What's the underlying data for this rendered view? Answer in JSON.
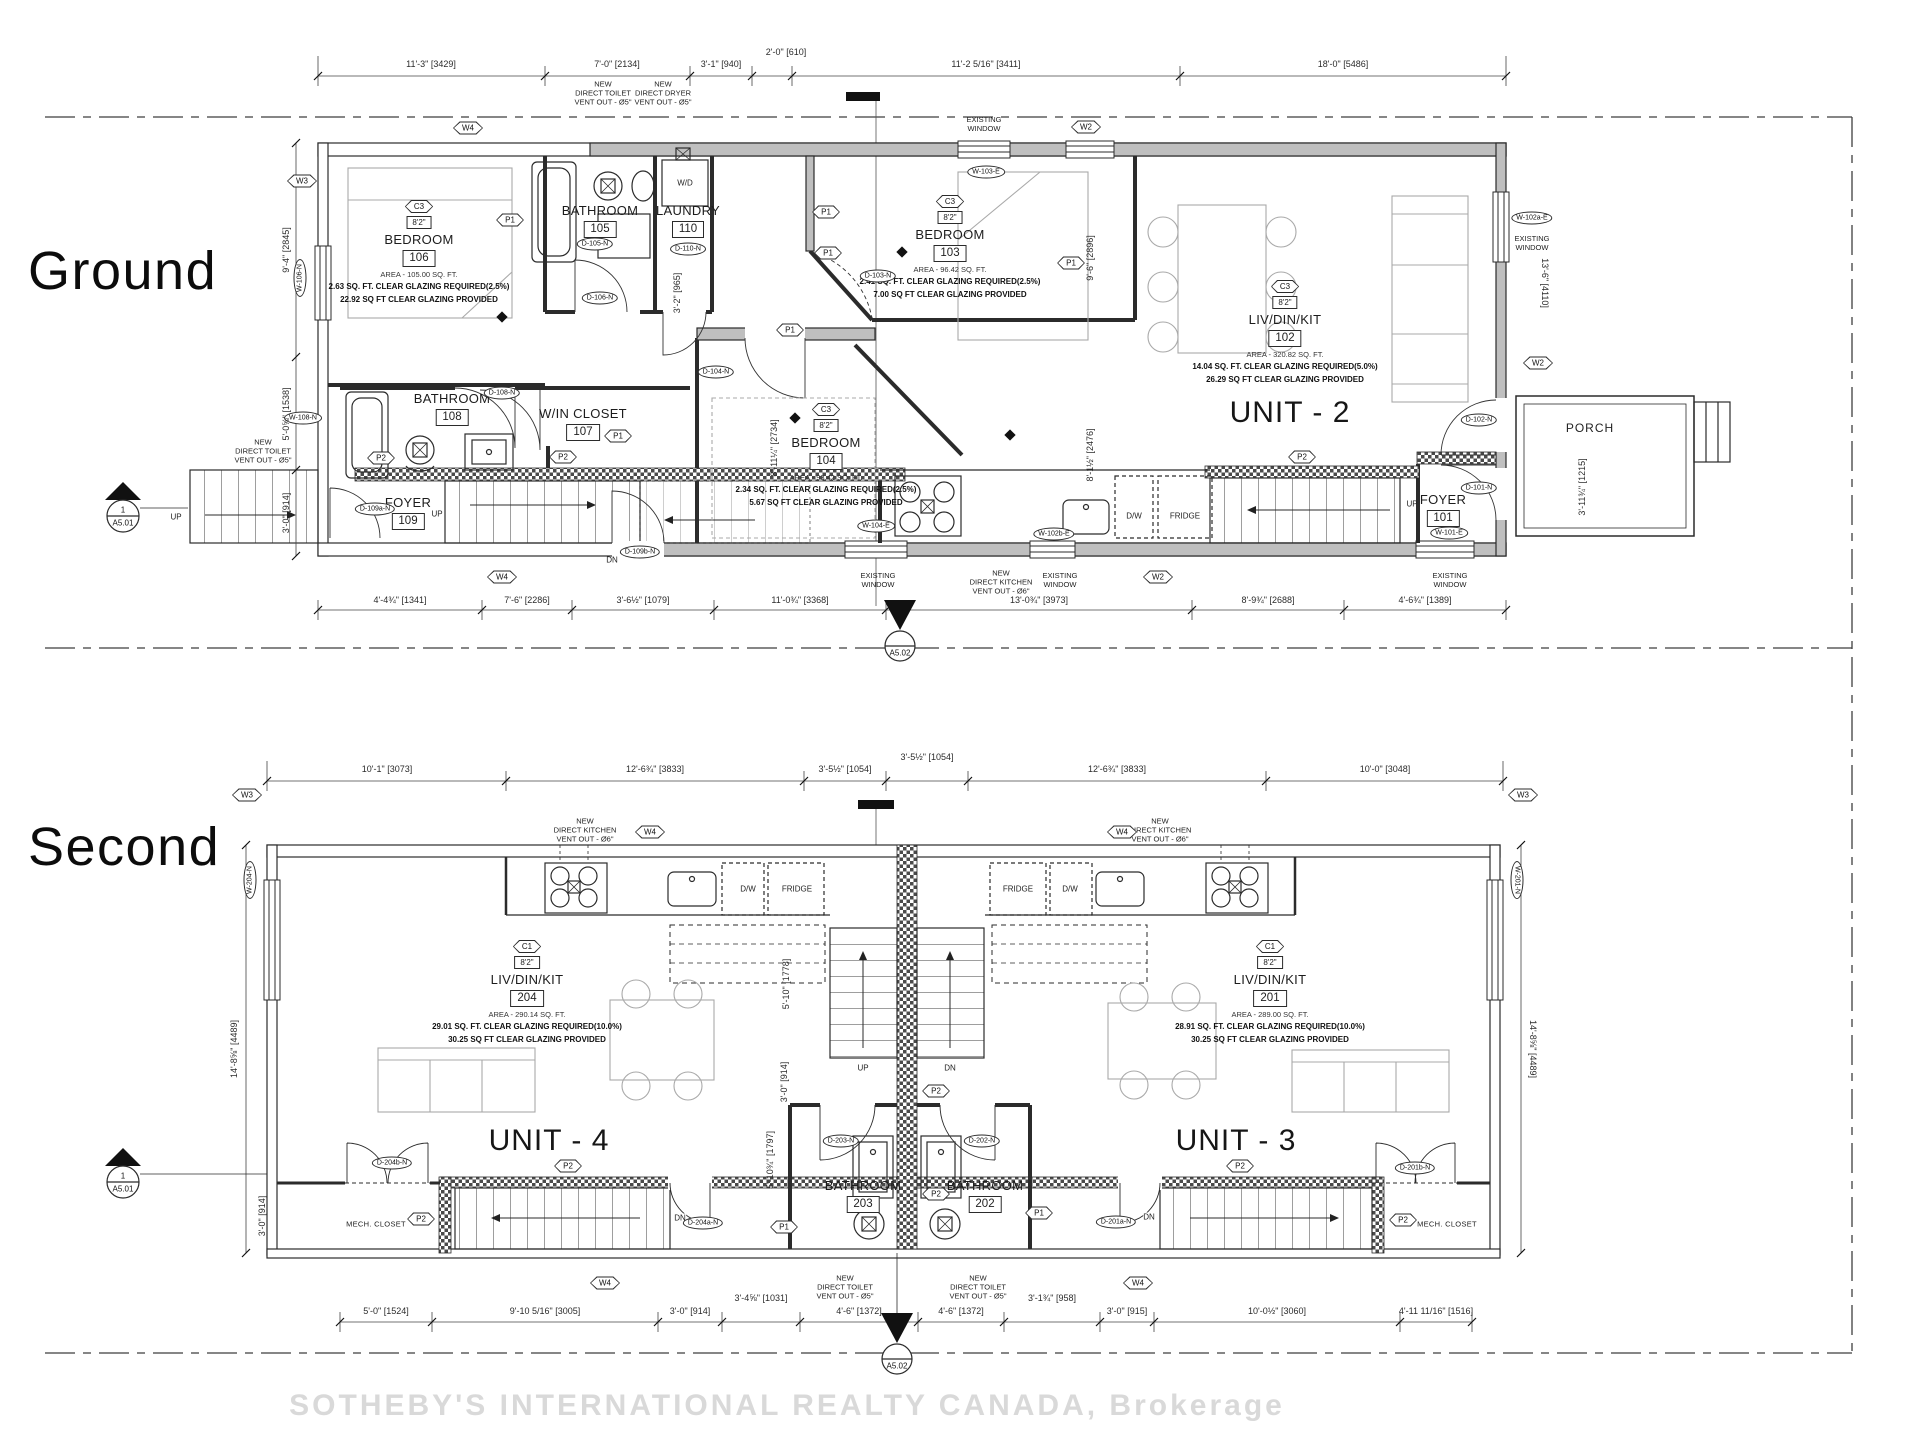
{
  "watermark": "SOTHEBY'S INTERNATIONAL REALTY CANADA, Brokerage",
  "floor_labels": {
    "ground": "Ground",
    "second": "Second"
  },
  "units": {
    "u2": "UNIT - 2",
    "u3": "UNIT - 3",
    "u4": "UNIT - 4"
  },
  "tags": {
    "w2": "W2",
    "w3": "W3",
    "w4": "W4",
    "p1": "P1",
    "p2": "P2",
    "c1": "C1",
    "c3": "C3"
  },
  "markers": {
    "one": "1",
    "a501": "A5.01",
    "a502": "A5.02"
  },
  "rooms": {
    "b106": {
      "tag": "C3",
      "ceil": "8'2\"",
      "name": "BEDROOM",
      "num": "106",
      "area": "AREA - 105.00 SQ. FT.",
      "req": "2.63 SQ. FT. CLEAR GLAZING REQUIRED(2.5%)",
      "prov": "22.92 SQ FT CLEAR GLAZING PROVIDED"
    },
    "b103": {
      "tag": "C3",
      "ceil": "8'2\"",
      "name": "BEDROOM",
      "num": "103",
      "area": "AREA - 96.42 SQ. FT.",
      "req": "2.41 SQ. FT. CLEAR GLAZING REQUIRED(2.5%)",
      "prov": "7.00 SQ FT CLEAR GLAZING PROVIDED"
    },
    "b104": {
      "tag": "C3",
      "ceil": "8'2\"",
      "name": "BEDROOM",
      "num": "104",
      "area": "AREA - 93.42 SQ. FT.",
      "req": "2.34 SQ. FT. CLEAR GLAZING REQUIRED(2.5%)",
      "prov": "5.67 SQ FT CLEAR GLAZING PROVIDED"
    },
    "l102": {
      "tag": "C3",
      "ceil": "8'2\"",
      "name": "LIV/DIN/KIT",
      "num": "102",
      "area": "AREA - 320.82 SQ. FT.",
      "req": "14.04 SQ. FT. CLEAR GLAZING REQUIRED(5.0%)",
      "prov": "26.29 SQ FT CLEAR GLAZING PROVIDED"
    },
    "l204": {
      "tag": "C1",
      "ceil": "8'2\"",
      "name": "LIV/DIN/KIT",
      "num": "204",
      "area": "AREA - 290.14 SQ. FT.",
      "req": "29.01 SQ. FT. CLEAR GLAZING REQUIRED(10.0%)",
      "prov": "30.25 SQ FT CLEAR GLAZING PROVIDED"
    },
    "l201": {
      "tag": "C1",
      "ceil": "8'2\"",
      "name": "LIV/DIN/KIT",
      "num": "201",
      "area": "AREA - 289.00 SQ. FT.",
      "req": "28.91 SQ. FT. CLEAR GLAZING REQUIRED(10.0%)",
      "prov": "30.25 SQ FT CLEAR GLAZING PROVIDED"
    },
    "bath105": {
      "name": "BATHROOM",
      "num": "105"
    },
    "laundry110": {
      "name": "LAUNDRY",
      "num": "110"
    },
    "bath108": {
      "name": "BATHROOM",
      "num": "108"
    },
    "wic107": {
      "name": "W/IN CLOSET",
      "num": "107"
    },
    "foyer109": {
      "name": "FOYER",
      "num": "109"
    },
    "foyer101": {
      "name": "FOYER",
      "num": "101"
    },
    "bath203": {
      "name": "BATHROOM",
      "num": "203"
    },
    "bath202": {
      "name": "BATHROOM",
      "num": "202"
    }
  },
  "labels": {
    "up": "UP",
    "dn": "DN",
    "wd": "W/D",
    "dw": "D/W",
    "fridge": "FRIDGE",
    "porch": "PORCH",
    "mech": "MECH. CLOSET"
  },
  "notes": {
    "toilet": "NEW\nDIRECT TOILET\nVENT OUT - Ø5\"",
    "dryer": "NEW\nDIRECT DRYER\nVENT OUT - Ø5\"",
    "kitchen": "NEW\nDIRECT KITCHEN\nVENT OUT - Ø6\"",
    "existing": "EXISTING\nWINDOW"
  },
  "ids": {
    "w106": "W-106-N",
    "w108": "W-108-N",
    "w101": "W-101-E",
    "w103": "W-103-E",
    "w104": "W-104-E",
    "w102a": "W-102a-E",
    "w102b": "W-102b-E",
    "w204": "W-204-N",
    "w201": "W-201-N",
    "d105": "D-105-N",
    "d106": "D-106-N",
    "d110": "D-110-N",
    "d103": "D-103-N",
    "d104": "D-104-N",
    "d108": "D-108-N",
    "d109a": "D-109a-N",
    "d109b": "D-109b-N",
    "d102": "D-102-N",
    "d101": "D-101-N",
    "d204a": "D-204a-N",
    "d204b": "D-204b-N",
    "d203": "D-203-N",
    "d202": "D-202-N",
    "d201a": "D-201a-N",
    "d201b": "D-201b-N"
  },
  "dims": {
    "ground_top": [
      "11'-3\" [3429]",
      "7'-0\" [2134]",
      "3'-1\" [940]",
      "2'-0\" [610]",
      "11'-2 5/16\" [3411]",
      "18'-0\" [5486]"
    ],
    "ground_bottom": [
      "4'-4¾\" [1341]",
      "7'-6\" [2286]",
      "3'-6½\" [1079]",
      "11'-0¾\" [3368]",
      "13'-0¾\" [3973]",
      "8'-9¾\" [2688]",
      "4'-6¾\" [1389]"
    ],
    "ground_left": [
      "9'-4\" [2845]",
      "5'-0⅝\" [1538]",
      "3'-0\" [914]"
    ],
    "ground_right": [
      "13'-6\" [4110]",
      "3'-11¾\" [1215]"
    ],
    "ground_inner": [
      "3'-2\" [965]",
      "8'-11¼\" [2734]",
      "9'-6\" [2896]",
      "8'-1½\" [2476]"
    ],
    "second_top": [
      "10'-1\" [3073]",
      "12'-6¾\" [3833]",
      "3'-5½\" [1054]",
      "3'-5½\" [1054]",
      "12'-6¾\" [3833]",
      "10'-0\" [3048]"
    ],
    "second_bottom": [
      "5'-0\" [1524]",
      "9'-10 5/16\" [3005]",
      "3'-0\" [914]",
      "3'-4⅝\" [1031]",
      "4'-6\" [1372]",
      "4'-6\" [1372]",
      "3'-1¾\" [958]",
      "3'-0\" [915]",
      "10'-0½\" [3060]",
      "4'-11 11/16\" [1516]"
    ],
    "second_left": [
      "14'-8⅝\" [4489]",
      "3'-0\" [914]"
    ],
    "second_right": [
      "14'-8⅝\" [4489]"
    ],
    "second_inner": [
      "5'-10\" [1778]",
      "3'-0\" [914]",
      "5'-10¾\" [1797]"
    ]
  }
}
